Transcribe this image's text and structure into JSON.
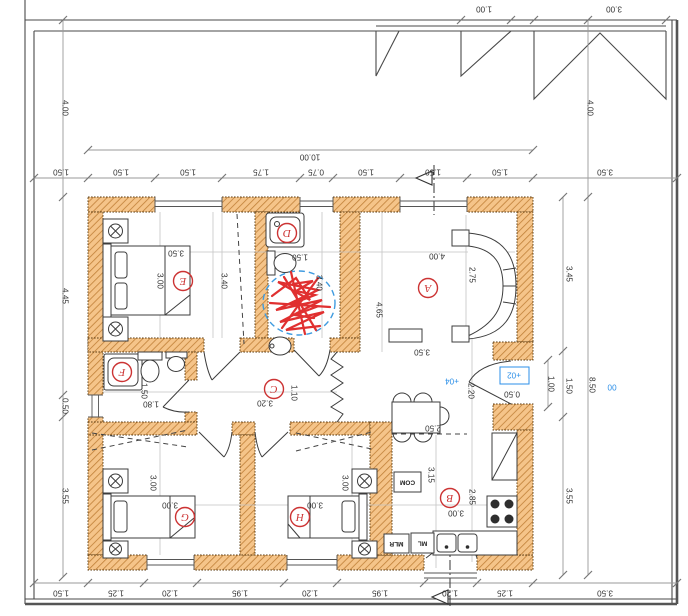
{
  "plan": {
    "rooms": [
      {
        "id": "A",
        "label": "A",
        "dims": [
          "4.00",
          "2.75",
          "4.65",
          "3.50"
        ]
      },
      {
        "id": "B",
        "label": "B",
        "dims": [
          "2.50",
          "2.20",
          "3.15",
          "2.85",
          "3.00",
          "0.50"
        ]
      },
      {
        "id": "C",
        "label": "C",
        "dims": [
          "3.20",
          "1.10"
        ]
      },
      {
        "id": "D",
        "label": "D",
        "dims": [
          "1.50",
          "3.40"
        ]
      },
      {
        "id": "E",
        "label": "E",
        "dims": [
          "3.50",
          "3.00"
        ]
      },
      {
        "id": "F",
        "label": "F",
        "dims": [
          "1.50",
          "1.80"
        ]
      },
      {
        "id": "G",
        "label": "G",
        "dims": [
          "3.00",
          "3.00"
        ]
      },
      {
        "id": "H",
        "label": "H",
        "dims": [
          "3.00",
          "3.00"
        ]
      }
    ],
    "hall_dim": "3.40",
    "dims": {
      "top": [
        "1.50",
        "1.50",
        "1.50",
        "1.75",
        "0.75",
        "1.50",
        "1.50",
        "1.50",
        "3.50"
      ],
      "top_overall": "10.00",
      "bottom": [
        "1.50",
        "1.25",
        "1.20",
        "1.95",
        "1.20",
        "1.95",
        "1.20",
        "1.25",
        "3.50"
      ],
      "left": [
        "4.00",
        "4.45",
        "0.50",
        "3.55"
      ],
      "right": [
        "3.45",
        "1.50",
        "3.55",
        "1.00",
        "4.00",
        "8.50"
      ],
      "roof": [
        "1.00",
        "3.00"
      ]
    },
    "levels": {
      "dining": "+04",
      "entry": "+02",
      "site": "00"
    },
    "appliances": {
      "com": "COM",
      "ml": "ML",
      "mlr": "MLR"
    },
    "colors": {
      "wall_fill": "#f5c489",
      "wall_hatch": "#c08038",
      "room_label_red": "#cc3333",
      "level_blue": "#2b8fe8",
      "scribble_red": "#e03030",
      "scribble_circle_blue": "#3f9be0"
    }
  }
}
